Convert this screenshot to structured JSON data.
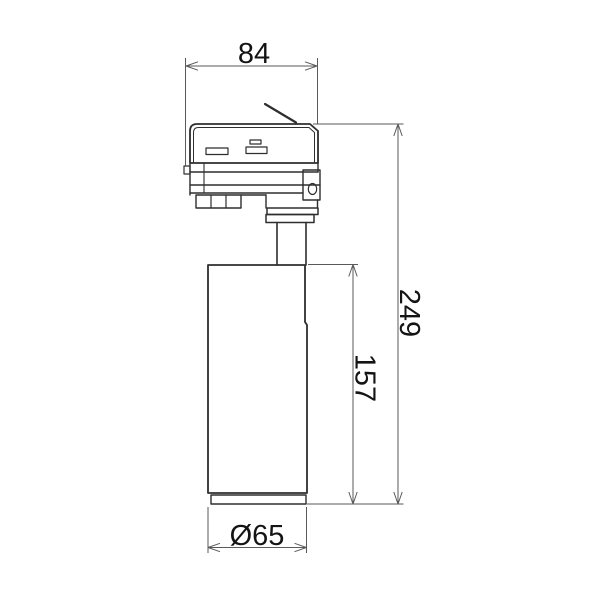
{
  "drawing": {
    "labels": {
      "width": "84",
      "total_height": "249",
      "body_height": "157",
      "body_diameter": "Ø65"
    },
    "colors": {
      "background": "#ffffff",
      "outline": "#2e2e2e",
      "dimension_line": "#5a5a5a",
      "text": "#141414"
    }
  }
}
